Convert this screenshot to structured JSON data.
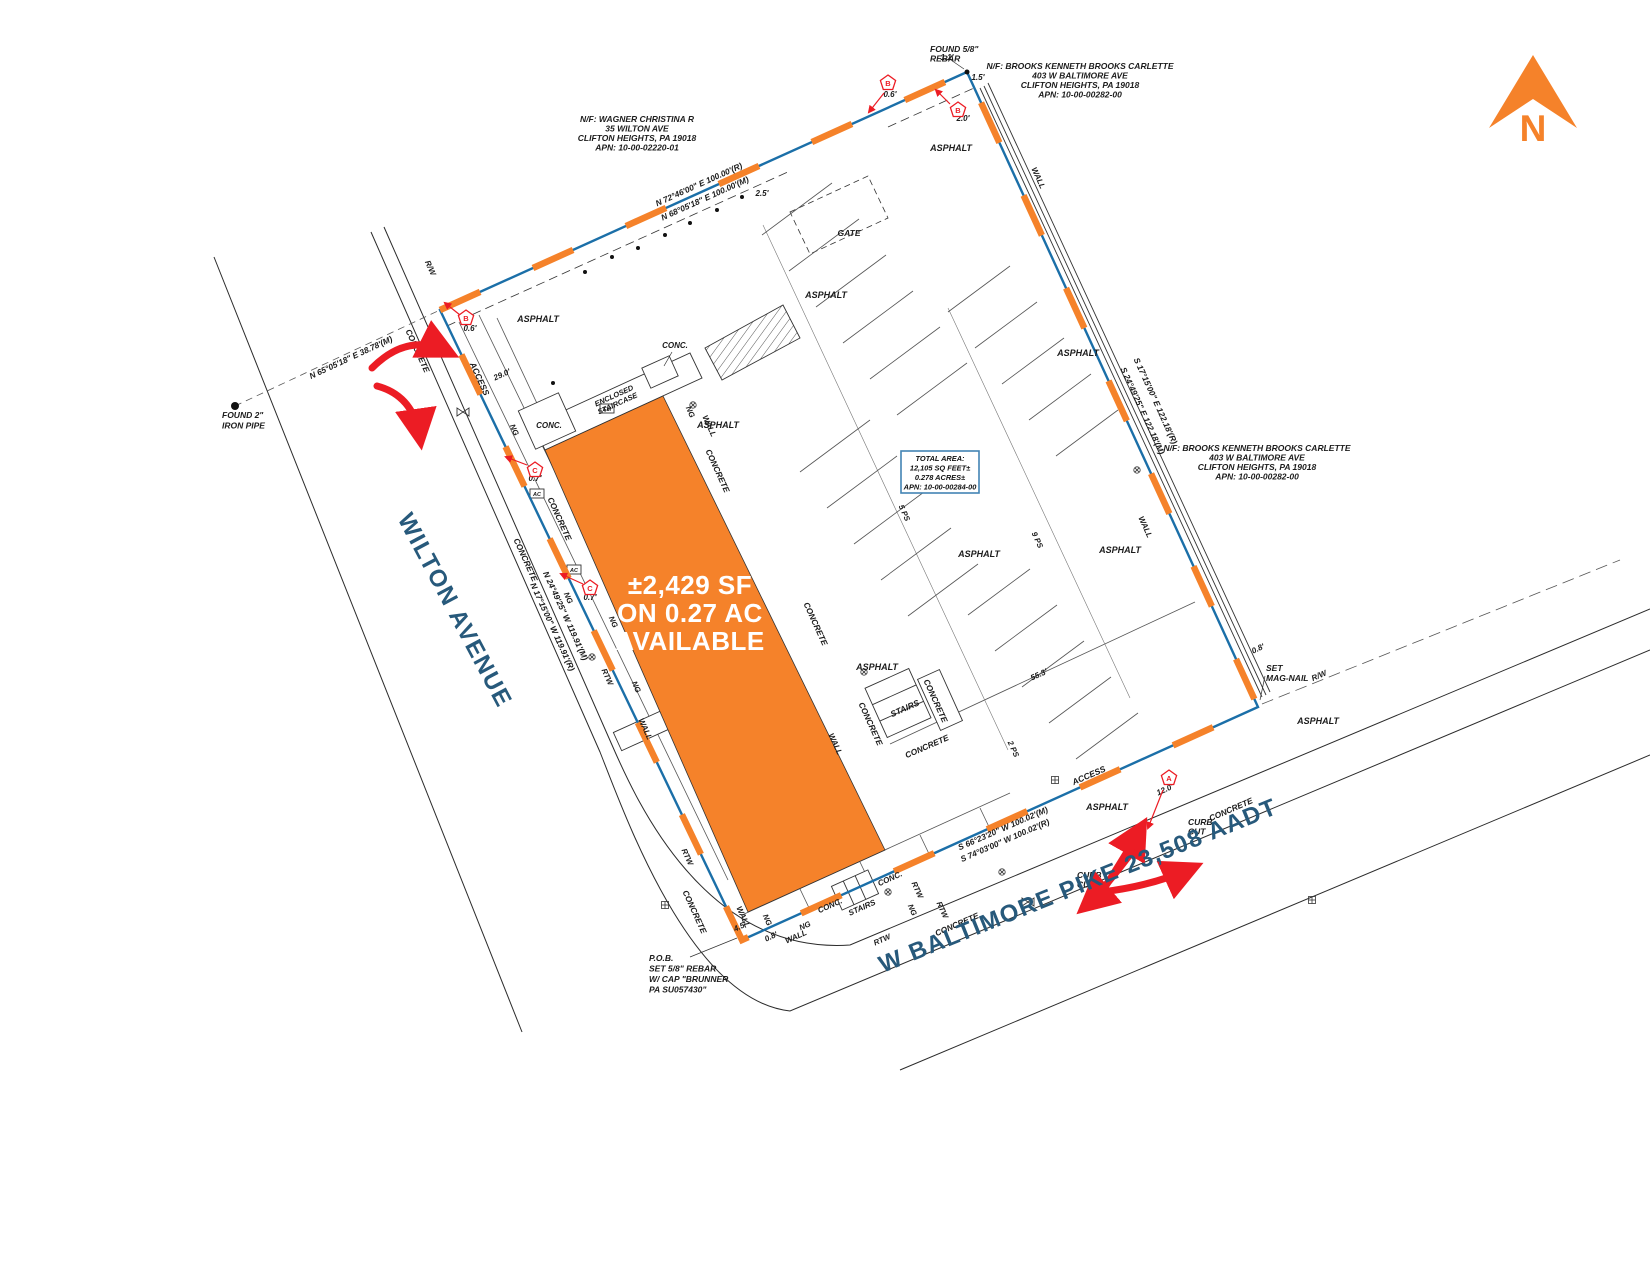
{
  "north_label": "N",
  "streets": {
    "wilton": "WILTON AVENUE",
    "baltimore": "W BALTIMORE PIKE 23,508 AADT"
  },
  "available": {
    "line1": "±2,429 SF",
    "line2": "ON 0.27 AC",
    "line3": "AVAILABLE"
  },
  "total_area": {
    "line1": "TOTAL AREA:",
    "line2": "12,105 SQ FEET±",
    "line3": "0.278 ACRES±",
    "line4": "APN: 10-00-00284-00"
  },
  "colors": {
    "orange": "#F5822A",
    "blue_line": "#1B6FA8",
    "navy": "#27597B",
    "red": "#EC1C24",
    "ink": "#1C1C1C",
    "box_border": "#4284B4"
  },
  "pentagons": [
    {
      "letter": "B",
      "x": 888,
      "y": 83
    },
    {
      "letter": "B",
      "x": 958,
      "y": 110
    },
    {
      "letter": "B",
      "x": 466,
      "y": 318
    },
    {
      "letter": "C",
      "x": 535,
      "y": 470
    },
    {
      "letter": "C",
      "x": 590,
      "y": 588
    },
    {
      "letter": "A",
      "x": 1169,
      "y": 778
    }
  ],
  "labels": [
    {
      "id": "found-rebar-label",
      "t": [
        "FOUND 5/8\"",
        "REBAR"
      ],
      "x": 930,
      "y": 52,
      "a": "s",
      "s": 8.5,
      "lh": 9.5
    },
    {
      "id": "neighbor-brooks-north",
      "t": [
        "N/F: BROOKS KENNETH BROOKS CARLETTE",
        "403 W BALTIMORE AVE",
        "CLIFTON HEIGHTS, PA 19018",
        "APN: 10-00-00282-00"
      ],
      "x": 1080,
      "y": 69,
      "s": 8.5,
      "lh": 9.5
    },
    {
      "id": "neighbor-wagner",
      "t": [
        "N/F: WAGNER CHRISTINA R",
        "35 WILTON AVE",
        "CLIFTON HEIGHTS, PA 19018",
        "APN: 10-00-02220-01"
      ],
      "x": 637,
      "y": 122,
      "s": 8.5,
      "lh": 9.5
    },
    {
      "id": "neighbor-brooks-east",
      "t": [
        "N/F: BROOKS KENNETH BROOKS CARLETTE",
        "403 W BALTIMORE AVE",
        "CLIFTON HEIGHTS, PA 19018",
        "APN: 10-00-00282-00"
      ],
      "x": 1257,
      "y": 451,
      "s": 8.5,
      "lh": 9.5
    },
    {
      "id": "bearing-north-record",
      "t": "N 72°46'00\" E  100.00'(R)",
      "x": 700,
      "y": 187,
      "r": -24.3,
      "s": 8.3
    },
    {
      "id": "bearing-north-measured",
      "t": "N 68°05'18\" E  100.00'(M)",
      "x": 706,
      "y": 201,
      "r": -24.3,
      "s": 8.3
    },
    {
      "id": "bearing-wilton-tie",
      "t": "N 65°05'18\" E  38.78'(M)",
      "x": 352,
      "y": 360,
      "r": -25,
      "s": 8.3
    },
    {
      "id": "bearing-west-measured",
      "t": "N 24°49'25\" W  119.91'(M)",
      "x": 563,
      "y": 617,
      "r": 65.5,
      "s": 8.3
    },
    {
      "id": "bearing-west-record",
      "t": "N 17°15'00\" W  119.91'(R)",
      "x": 550,
      "y": 628,
      "r": 65.5,
      "s": 8.3
    },
    {
      "id": "bearing-east-record",
      "t": "S 17°15'00\" E  122.18'(R)",
      "x": 1153,
      "y": 402,
      "r": 65.5,
      "s": 8.3
    },
    {
      "id": "bearing-east-measured",
      "t": "S 24°49'25\" E  122.18'(M)",
      "x": 1140,
      "y": 412,
      "r": 65.5,
      "s": 8.3
    },
    {
      "id": "bearing-south-measured",
      "t": "S 66°23'20\" W  100.02'(M)",
      "x": 1004,
      "y": 831,
      "r": -23.5,
      "s": 8.3
    },
    {
      "id": "bearing-south-record",
      "t": "S 74°03'00\" W  100.02'(R)",
      "x": 1006,
      "y": 843,
      "r": -23.5,
      "s": 8.3
    },
    {
      "id": "dim-2-5",
      "t": "2.5'",
      "x": 762,
      "y": 196,
      "s": 8
    },
    {
      "id": "dim-1-1",
      "t": "1.1'",
      "x": 947,
      "y": 60,
      "s": 8
    },
    {
      "id": "dim-1-5",
      "t": "1.5'",
      "x": 978,
      "y": 80,
      "s": 8
    },
    {
      "id": "dim-29-0",
      "t": "29.0'",
      "x": 503,
      "y": 377,
      "r": -24.5,
      "s": 8
    },
    {
      "id": "dim-55-3",
      "t": "55.3'",
      "x": 1040,
      "y": 677,
      "r": -24.5,
      "s": 8
    },
    {
      "id": "dim-4-5",
      "t": "4.5'",
      "x": 741,
      "y": 929,
      "r": -24.5,
      "s": 8
    },
    {
      "id": "dim-0-8-sw",
      "t": "0.8'",
      "x": 772,
      "y": 939,
      "r": -24.5,
      "s": 8
    },
    {
      "id": "dim-0-8-se",
      "t": "0.8'",
      "x": 1259,
      "y": 651,
      "r": -24.5,
      "s": 8
    },
    {
      "id": "dim-0-6-north",
      "t": "0.6'",
      "x": 890,
      "y": 97,
      "c": "red",
      "s": 8
    },
    {
      "id": "dim-2-0",
      "t": "2.0'",
      "x": 963,
      "y": 121,
      "c": "red",
      "s": 8
    },
    {
      "id": "dim-0-6-west",
      "t": "0.6'",
      "x": 470,
      "y": 331,
      "c": "red",
      "s": 8
    },
    {
      "id": "dim-0-7-a",
      "t": "0.7'",
      "x": 535,
      "y": 481,
      "c": "red",
      "s": 8
    },
    {
      "id": "dim-0-7-b",
      "t": "0.7'",
      "x": 590,
      "y": 600,
      "c": "red",
      "s": 8
    },
    {
      "id": "dim-12-0",
      "t": "12.0'",
      "x": 1166,
      "y": 792,
      "r": -24.5,
      "c": "red",
      "s": 8
    },
    {
      "id": "gate-label",
      "t": "GATE",
      "x": 849,
      "y": 236,
      "s": 8.5
    },
    {
      "id": "asphalt-1",
      "t": "ASPHALT",
      "x": 951,
      "y": 151,
      "s": 9
    },
    {
      "id": "asphalt-2",
      "t": "ASPHALT",
      "x": 538,
      "y": 322,
      "s": 9
    },
    {
      "id": "asphalt-3",
      "t": "ASPHALT",
      "x": 826,
      "y": 298,
      "s": 9
    },
    {
      "id": "asphalt-4",
      "t": "ASPHALT",
      "x": 1078,
      "y": 356,
      "s": 9
    },
    {
      "id": "asphalt-5",
      "t": "ASPHALT",
      "x": 718,
      "y": 428,
      "s": 9
    },
    {
      "id": "asphalt-6",
      "t": "ASPHALT",
      "x": 979,
      "y": 557,
      "s": 9
    },
    {
      "id": "asphalt-7",
      "t": "ASPHALT",
      "x": 1120,
      "y": 553,
      "s": 9
    },
    {
      "id": "asphalt-8",
      "t": "ASPHALT",
      "x": 877,
      "y": 670,
      "s": 9
    },
    {
      "id": "asphalt-9",
      "t": "ASPHALT",
      "x": 1107,
      "y": 810,
      "s": 9
    },
    {
      "id": "asphalt-10",
      "t": "ASPHALT",
      "x": 1318,
      "y": 724,
      "s": 9
    },
    {
      "id": "concrete-w1",
      "t": "CONCRETE",
      "x": 415,
      "y": 352,
      "r": 65.5,
      "s": 8.3
    },
    {
      "id": "concrete-w2",
      "t": "CONCRETE",
      "x": 557,
      "y": 520,
      "r": 65.5,
      "s": 8.3
    },
    {
      "id": "concrete-w3",
      "t": "CONCRETE",
      "x": 523,
      "y": 561,
      "r": 65.5,
      "s": 8.3
    },
    {
      "id": "concrete-m1",
      "t": "CONCRETE",
      "x": 715,
      "y": 472,
      "r": 65.5,
      "s": 8.3
    },
    {
      "id": "concrete-m2",
      "t": "CONCRETE",
      "x": 813,
      "y": 625,
      "r": 65.5,
      "s": 8.3
    },
    {
      "id": "concrete-m3",
      "t": "CONCRETE",
      "x": 868,
      "y": 725,
      "r": 65.5,
      "s": 8.3
    },
    {
      "id": "concrete-m4",
      "t": "CONCRETE",
      "x": 933,
      "y": 702,
      "r": 65.5,
      "s": 8.3
    },
    {
      "id": "concrete-sw",
      "t": "CONCRETE",
      "x": 692,
      "y": 913,
      "r": 65.5,
      "s": 8.3
    },
    {
      "id": "concrete-s1",
      "t": "CONCRETE",
      "x": 928,
      "y": 749,
      "r": -23.5,
      "s": 8.3
    },
    {
      "id": "concrete-s2",
      "t": "CONCRETE",
      "x": 1232,
      "y": 812,
      "r": -23.5,
      "s": 8.3
    },
    {
      "id": "concrete-s3",
      "t": "CONCRETE",
      "x": 958,
      "y": 927,
      "r": -23.5,
      "s": 8.3
    },
    {
      "id": "conc-1",
      "t": "CONC.",
      "x": 549,
      "y": 428,
      "s": 8
    },
    {
      "id": "conc-2",
      "t": "CONC.",
      "x": 675,
      "y": 348,
      "s": 8
    },
    {
      "id": "conc-3",
      "t": "CONC.",
      "x": 831,
      "y": 908,
      "r": -24,
      "s": 8
    },
    {
      "id": "conc-4",
      "t": "CONC.",
      "x": 891,
      "y": 881,
      "r": -24,
      "s": 8
    },
    {
      "id": "ng-1",
      "t": "NG",
      "x": 512,
      "y": 431,
      "r": 65.5,
      "s": 7.8
    },
    {
      "id": "ng-2",
      "t": "NG",
      "x": 688,
      "y": 413,
      "r": 65.5,
      "s": 7.8
    },
    {
      "id": "ng-3",
      "t": "NG",
      "x": 566,
      "y": 599,
      "r": 65.5,
      "s": 7.8
    },
    {
      "id": "ng-4",
      "t": "NG",
      "x": 611,
      "y": 623,
      "r": 65.5,
      "s": 7.8
    },
    {
      "id": "ng-5",
      "t": "NG",
      "x": 634,
      "y": 688,
      "r": 65.5,
      "s": 7.8
    },
    {
      "id": "ng-6",
      "t": "NG",
      "x": 765,
      "y": 921,
      "r": 65.5,
      "s": 7.8
    },
    {
      "id": "ng-7",
      "t": "NG",
      "x": 806,
      "y": 928,
      "r": -24,
      "s": 7.8
    },
    {
      "id": "ng-8",
      "t": "NG",
      "x": 910,
      "y": 911,
      "r": 65.5,
      "s": 7.8
    },
    {
      "id": "rtw-1",
      "t": "RTW",
      "x": 605,
      "y": 678,
      "r": 65.5,
      "s": 7.8
    },
    {
      "id": "rtw-2",
      "t": "RTW",
      "x": 685,
      "y": 858,
      "r": 65.5,
      "s": 7.8
    },
    {
      "id": "rtw-3",
      "t": "RTW",
      "x": 915,
      "y": 891,
      "r": 65.5,
      "s": 7.8
    },
    {
      "id": "rtw-4",
      "t": "RTW",
      "x": 940,
      "y": 911,
      "r": 65.5,
      "s": 7.8
    },
    {
      "id": "rtw-5",
      "t": "RTW",
      "x": 883,
      "y": 942,
      "r": -24,
      "s": 7.8
    },
    {
      "id": "wall-1",
      "t": "WALL",
      "x": 1036,
      "y": 179,
      "r": 65.5,
      "s": 8
    },
    {
      "id": "wall-2",
      "t": "WALL",
      "x": 1143,
      "y": 528,
      "r": 65.5,
      "s": 8
    },
    {
      "id": "wall-3",
      "t": "WALL",
      "x": 707,
      "y": 427,
      "r": 65.5,
      "s": 8
    },
    {
      "id": "wall-4",
      "t": "WALL",
      "x": 643,
      "y": 730,
      "r": 65.5,
      "s": 8
    },
    {
      "id": "wall-5",
      "t": "WALL",
      "x": 741,
      "y": 918,
      "r": 65.5,
      "s": 8
    },
    {
      "id": "wall-6",
      "t": "WALL",
      "x": 833,
      "y": 745,
      "r": 65.5,
      "s": 8
    },
    {
      "id": "wall-7",
      "t": "WALL",
      "x": 797,
      "y": 939,
      "r": -24,
      "s": 8
    },
    {
      "id": "stairs-1",
      "t": "STAIRS",
      "x": 906,
      "y": 711,
      "r": -24,
      "s": 8.5
    },
    {
      "id": "stairs-2",
      "t": "STAIRS",
      "x": 863,
      "y": 910,
      "r": -24,
      "s": 8
    },
    {
      "id": "access-west",
      "t": "ACCESS",
      "x": 477,
      "y": 380,
      "r": 65.5,
      "s": 8.5
    },
    {
      "id": "access-south",
      "t": "ACCESS",
      "x": 1090,
      "y": 778,
      "r": -23.5,
      "s": 8.5
    },
    {
      "id": "rw-west",
      "t": "R/W",
      "x": 428,
      "y": 269,
      "r": 65.5,
      "s": 8
    },
    {
      "id": "rw-east",
      "t": "R/W",
      "x": 1320,
      "y": 678,
      "r": -23.5,
      "s": 8
    },
    {
      "id": "parking-5ps",
      "t": "5 PS",
      "x": 902,
      "y": 514,
      "r": 65.5,
      "s": 7.8
    },
    {
      "id": "parking-9ps",
      "t": "9 PS",
      "x": 1035,
      "y": 541,
      "r": 65.5,
      "s": 7.8
    },
    {
      "id": "parking-2ps",
      "t": "2 PS",
      "x": 1011,
      "y": 750,
      "r": 65.5,
      "s": 7.8
    },
    {
      "id": "curb-cut-east",
      "t": [
        "CURB",
        "CUT"
      ],
      "x": 1188,
      "y": 825,
      "a": "s",
      "s": 8.5,
      "lh": 9.5
    },
    {
      "id": "curb-cut-west",
      "t": [
        "CURB",
        "CUT"
      ],
      "x": 1077,
      "y": 878,
      "a": "s",
      "s": 8.5,
      "lh": 9.5
    },
    {
      "id": "set-mag-nail",
      "t": [
        "SET",
        "MAG-NAIL"
      ],
      "x": 1266,
      "y": 671,
      "a": "s",
      "s": 8.5,
      "lh": 10
    },
    {
      "id": "pob-note",
      "t": [
        "P.O.B.",
        "SET 5/8\" REBAR",
        "W/ CAP \"BRUNNER",
        "PA SU057430\""
      ],
      "x": 649,
      "y": 961,
      "a": "s",
      "s": 8.5,
      "lh": 10.5
    },
    {
      "id": "found-iron-pipe",
      "t": [
        "FOUND 2\"",
        "IRON PIPE"
      ],
      "x": 222,
      "y": 418,
      "a": "s",
      "s": 8.5,
      "lh": 10.5
    },
    {
      "id": "enclosed-staircase",
      "t": [
        "ENCLOSED",
        "STAIRCASE"
      ],
      "x": 615,
      "y": 398,
      "r": -24.3,
      "s": 7.5,
      "lh": 8.5
    },
    {
      "id": "em-meter",
      "t": "EM",
      "x": 607,
      "y": 411,
      "s": 5.5
    },
    {
      "id": "ac-unit-1",
      "t": "AC",
      "x": 537,
      "y": 496,
      "s": 5.5
    },
    {
      "id": "ac-unit-2",
      "t": "AC",
      "x": 574,
      "y": 572,
      "s": 5.5
    }
  ]
}
